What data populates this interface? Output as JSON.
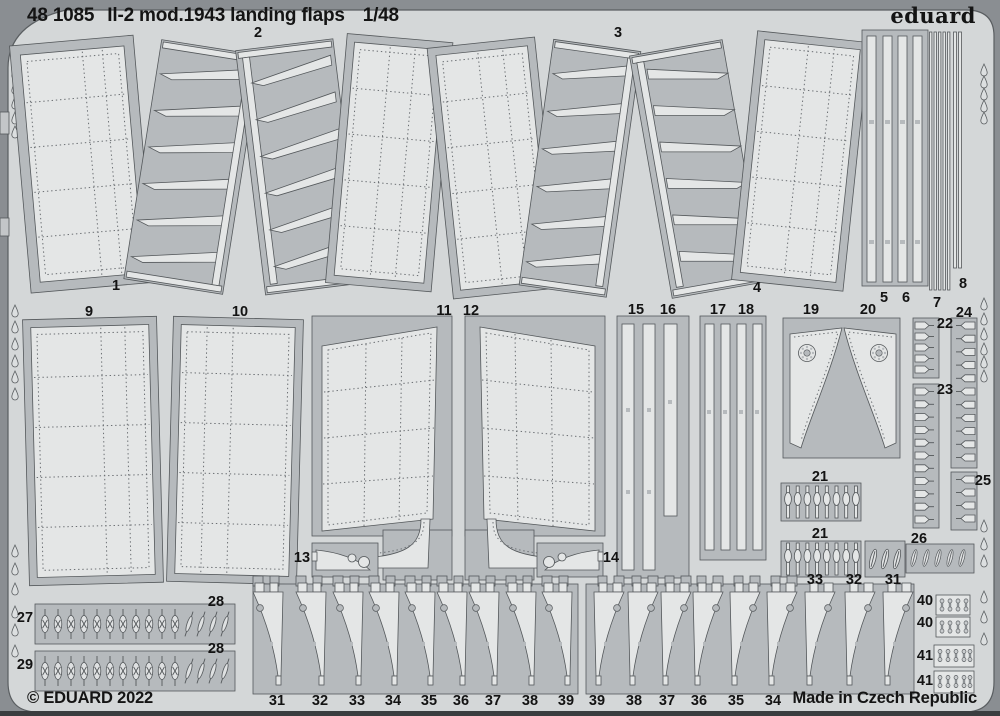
{
  "header": {
    "code": "48 1085",
    "title": "Il-2 mod.1943 landing flaps",
    "scale": "1/48",
    "brand": "eduard"
  },
  "footer": {
    "copyright": "© EDUARD 2022",
    "made_in": "Made in Czech Republic"
  },
  "colors": {
    "fret_surface": "#d4d7d8",
    "carrier_gray": "#b6babd",
    "part_light": "#e4e6e6",
    "outline": "#54585b",
    "background": "#8a8e92",
    "text": "#141414"
  },
  "part_labels": [
    {
      "text": "1",
      "x": 116,
      "y": 286
    },
    {
      "text": "2",
      "x": 258,
      "y": 33
    },
    {
      "text": "3",
      "x": 618,
      "y": 33
    },
    {
      "text": "4",
      "x": 757,
      "y": 288
    },
    {
      "text": "5",
      "x": 884,
      "y": 298
    },
    {
      "text": "6",
      "x": 906,
      "y": 298
    },
    {
      "text": "7",
      "x": 937,
      "y": 303
    },
    {
      "text": "8",
      "x": 963,
      "y": 284
    },
    {
      "text": "9",
      "x": 89,
      "y": 312
    },
    {
      "text": "10",
      "x": 240,
      "y": 312
    },
    {
      "text": "11",
      "x": 444,
      "y": 311
    },
    {
      "text": "12",
      "x": 471,
      "y": 311
    },
    {
      "text": "13",
      "x": 302,
      "y": 558
    },
    {
      "text": "14",
      "x": 611,
      "y": 558
    },
    {
      "text": "15",
      "x": 636,
      "y": 310
    },
    {
      "text": "16",
      "x": 668,
      "y": 310
    },
    {
      "text": "17",
      "x": 718,
      "y": 310
    },
    {
      "text": "18",
      "x": 746,
      "y": 310
    },
    {
      "text": "19",
      "x": 811,
      "y": 310
    },
    {
      "text": "20",
      "x": 868,
      "y": 310
    },
    {
      "text": "21",
      "x": 820,
      "y": 477
    },
    {
      "text": "21",
      "x": 820,
      "y": 534
    },
    {
      "text": "22",
      "x": 945,
      "y": 324
    },
    {
      "text": "23",
      "x": 945,
      "y": 390
    },
    {
      "text": "24",
      "x": 964,
      "y": 313
    },
    {
      "text": "25",
      "x": 983,
      "y": 481
    },
    {
      "text": "26",
      "x": 919,
      "y": 539
    },
    {
      "text": "27",
      "x": 25,
      "y": 618
    },
    {
      "text": "28",
      "x": 216,
      "y": 602
    },
    {
      "text": "28",
      "x": 216,
      "y": 649
    },
    {
      "text": "29",
      "x": 25,
      "y": 665
    },
    {
      "text": "33",
      "x": 815,
      "y": 580
    },
    {
      "text": "32",
      "x": 854,
      "y": 580
    },
    {
      "text": "31",
      "x": 893,
      "y": 580
    },
    {
      "text": "31",
      "x": 277,
      "y": 701
    },
    {
      "text": "32",
      "x": 320,
      "y": 701
    },
    {
      "text": "33",
      "x": 357,
      "y": 701
    },
    {
      "text": "34",
      "x": 393,
      "y": 701
    },
    {
      "text": "35",
      "x": 429,
      "y": 701
    },
    {
      "text": "36",
      "x": 461,
      "y": 701
    },
    {
      "text": "37",
      "x": 493,
      "y": 701
    },
    {
      "text": "38",
      "x": 530,
      "y": 701
    },
    {
      "text": "39",
      "x": 566,
      "y": 701
    },
    {
      "text": "39",
      "x": 597,
      "y": 701
    },
    {
      "text": "38",
      "x": 634,
      "y": 701
    },
    {
      "text": "37",
      "x": 667,
      "y": 701
    },
    {
      "text": "36",
      "x": 699,
      "y": 701
    },
    {
      "text": "35",
      "x": 736,
      "y": 701
    },
    {
      "text": "34",
      "x": 773,
      "y": 701
    },
    {
      "text": "40",
      "x": 925,
      "y": 601
    },
    {
      "text": "40",
      "x": 925,
      "y": 623
    },
    {
      "text": "41",
      "x": 925,
      "y": 656
    },
    {
      "text": "41",
      "x": 925,
      "y": 681
    }
  ]
}
